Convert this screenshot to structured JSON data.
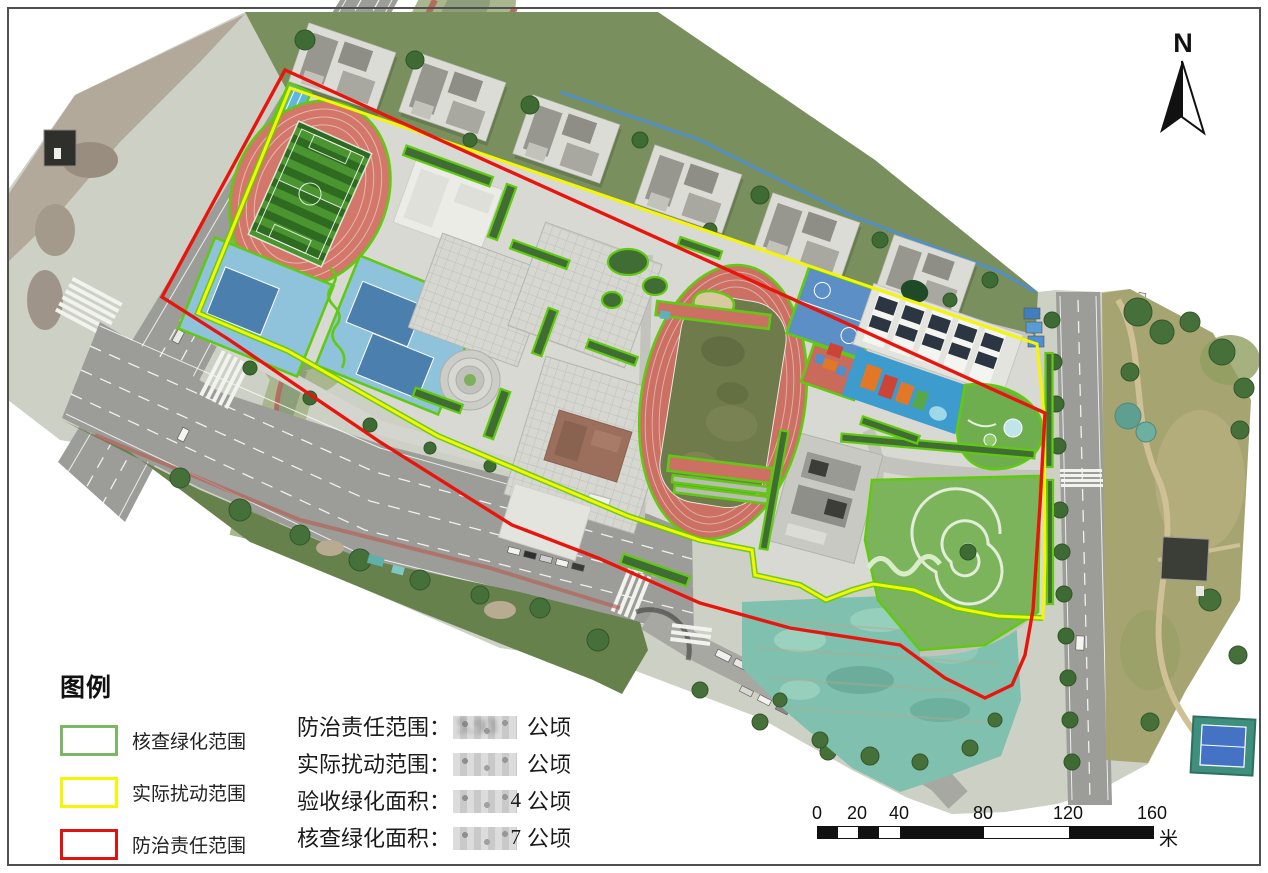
{
  "north": {
    "label": "N"
  },
  "legend": {
    "title": "图例",
    "items": [
      {
        "label": "核查绿化范围",
        "color": "#7cb768"
      },
      {
        "label": "实际扰动范围",
        "color": "#f6f600"
      },
      {
        "label": "防治责任范围",
        "color": "#dd1410"
      }
    ]
  },
  "stats": {
    "items": [
      {
        "label": "防治责任范围：",
        "value_blurred": "5.93",
        "value_visible": "",
        "unit": "公顷"
      },
      {
        "label": "实际扰动范围：",
        "value_blurred": "",
        "value_visible": "",
        "unit": "公顷"
      },
      {
        "label": "验收绿化面积：",
        "value_blurred": "",
        "value_visible": "4",
        "unit": "公顷"
      },
      {
        "label": "核查绿化面积：",
        "value_blurred": "",
        "value_visible": "7",
        "unit": "公顷"
      }
    ]
  },
  "scale_bar": {
    "labels": [
      "0",
      "20",
      "40",
      "80",
      "120",
      "160"
    ],
    "unit": "米"
  },
  "map_overlays": {
    "verified_green_outline_color": "#62c912",
    "disturbance_outline_color": "#f6f600",
    "responsibility_outline_color": "#e8150d"
  }
}
